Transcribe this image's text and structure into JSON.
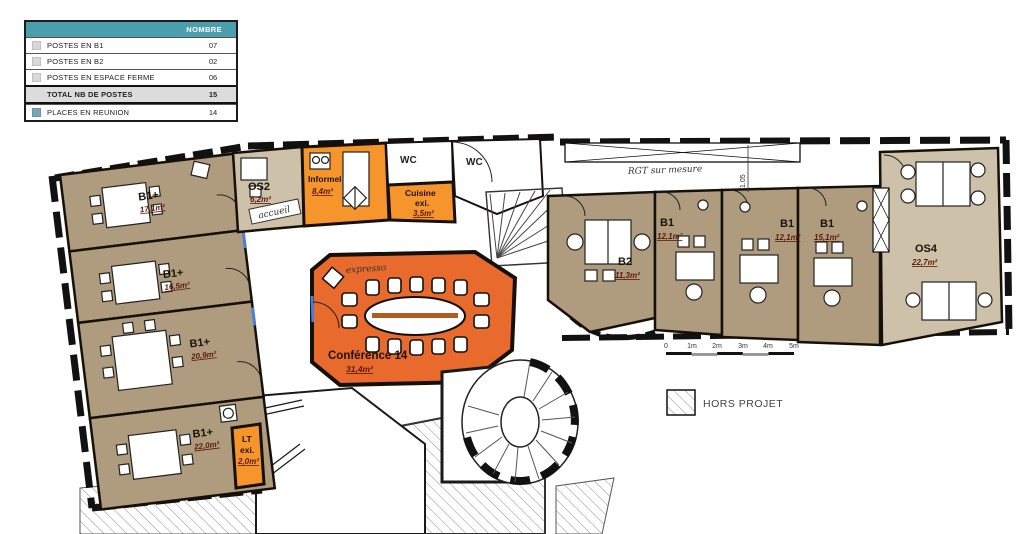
{
  "legend_table": {
    "header_label": "NOMBRE",
    "rows": [
      {
        "label": "POSTES EN B1",
        "value": "07"
      },
      {
        "label": "POSTES EN B2",
        "value": "02"
      },
      {
        "label": "POSTES EN ESPACE FERME",
        "value": "06"
      },
      {
        "label": "TOTAL NB DE POSTES",
        "value": "15"
      },
      {
        "label": "PLACES EN REUNION",
        "value": "14"
      }
    ]
  },
  "rooms": {
    "b1plus_1": {
      "name": "B1+",
      "area": "17,1m²"
    },
    "b1plus_2": {
      "name": "B1+",
      "area": "16,5m²"
    },
    "b1plus_3": {
      "name": "B1+",
      "area": "20,9m²"
    },
    "b1plus_4": {
      "name": "B1+",
      "area": "22,0m²"
    },
    "os2": {
      "name": "OS2",
      "area": "6,2m²"
    },
    "informel": {
      "name": "Informel",
      "area": "8,4m²"
    },
    "wc_left": {
      "name": "WC"
    },
    "wc_right": {
      "name": "WC"
    },
    "cuisine": {
      "name": "Cuisine",
      "suffix": "exi.",
      "area": "3,5m²"
    },
    "conference": {
      "name": "Conférence 14",
      "area": "31,4m²"
    },
    "b2": {
      "name": "B2",
      "area": "11,3m²"
    },
    "b1_a": {
      "name": "B1",
      "area": "12,1m²"
    },
    "b1_b": {
      "name": "B1",
      "area": "12,1m²"
    },
    "b1_c": {
      "name": "B1",
      "area": "15,1m²"
    },
    "os4": {
      "name": "OS4",
      "area": "22,7m²"
    },
    "lt": {
      "name": "LT",
      "suffix": "exi.",
      "area": "2,0m²"
    }
  },
  "annotations": {
    "accueil": "accueil",
    "expresso": "expresso",
    "rgt": "RGT sur mesure",
    "dim_105": "1.05"
  },
  "scale_bar": {
    "ticks": [
      "0",
      "1m",
      "2m",
      "3m",
      "4m",
      "5m"
    ]
  },
  "hors_projet_label": "HORS PROJET",
  "colors": {
    "room_tan": "#AF9C7E",
    "room_light_tan": "#CEC1A9",
    "orange": "#F6952C",
    "conference_orange": "#E96A2D",
    "teal_header": "#4A9EAD",
    "reunion_square": "#7BA3B9"
  }
}
